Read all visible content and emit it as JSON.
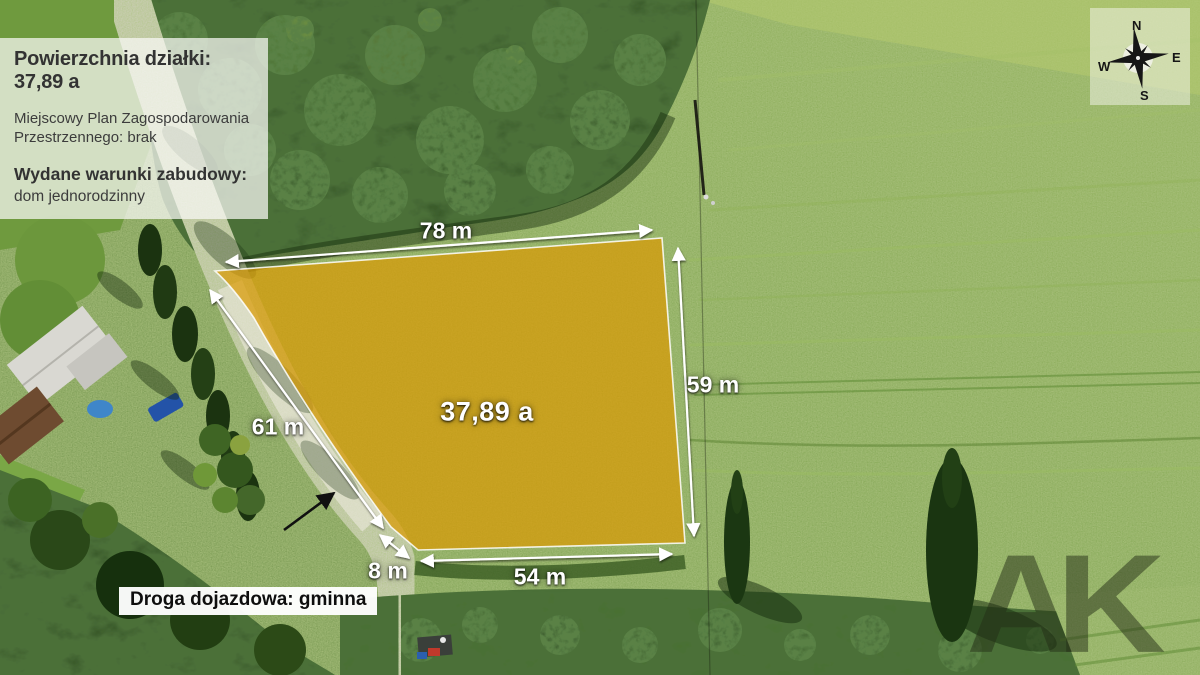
{
  "info_panel": {
    "title": "Powierzchnia działki: 37,89 a",
    "plan_lines": [
      "Miejscowy Plan Zagospodarowania",
      "Przestrzennego: brak"
    ],
    "permit_heading": "Wydane warunki zabudowy:",
    "permit_value": "dom jednorodzinny"
  },
  "plot": {
    "area_label": "37,89 a",
    "fill_color": "#D99A04",
    "outline_color": "#FFFFFF"
  },
  "measurements": {
    "top_edge": "78 m",
    "right_edge": "59 m",
    "left_edge": "61 m",
    "bottom_edge": "54 m",
    "corner_edge": "8 m"
  },
  "road_label": "Droga dojazdowa: gminna",
  "compass": {
    "north": "N",
    "east": "E",
    "south": "S",
    "west": "W"
  },
  "watermark": "AK"
}
